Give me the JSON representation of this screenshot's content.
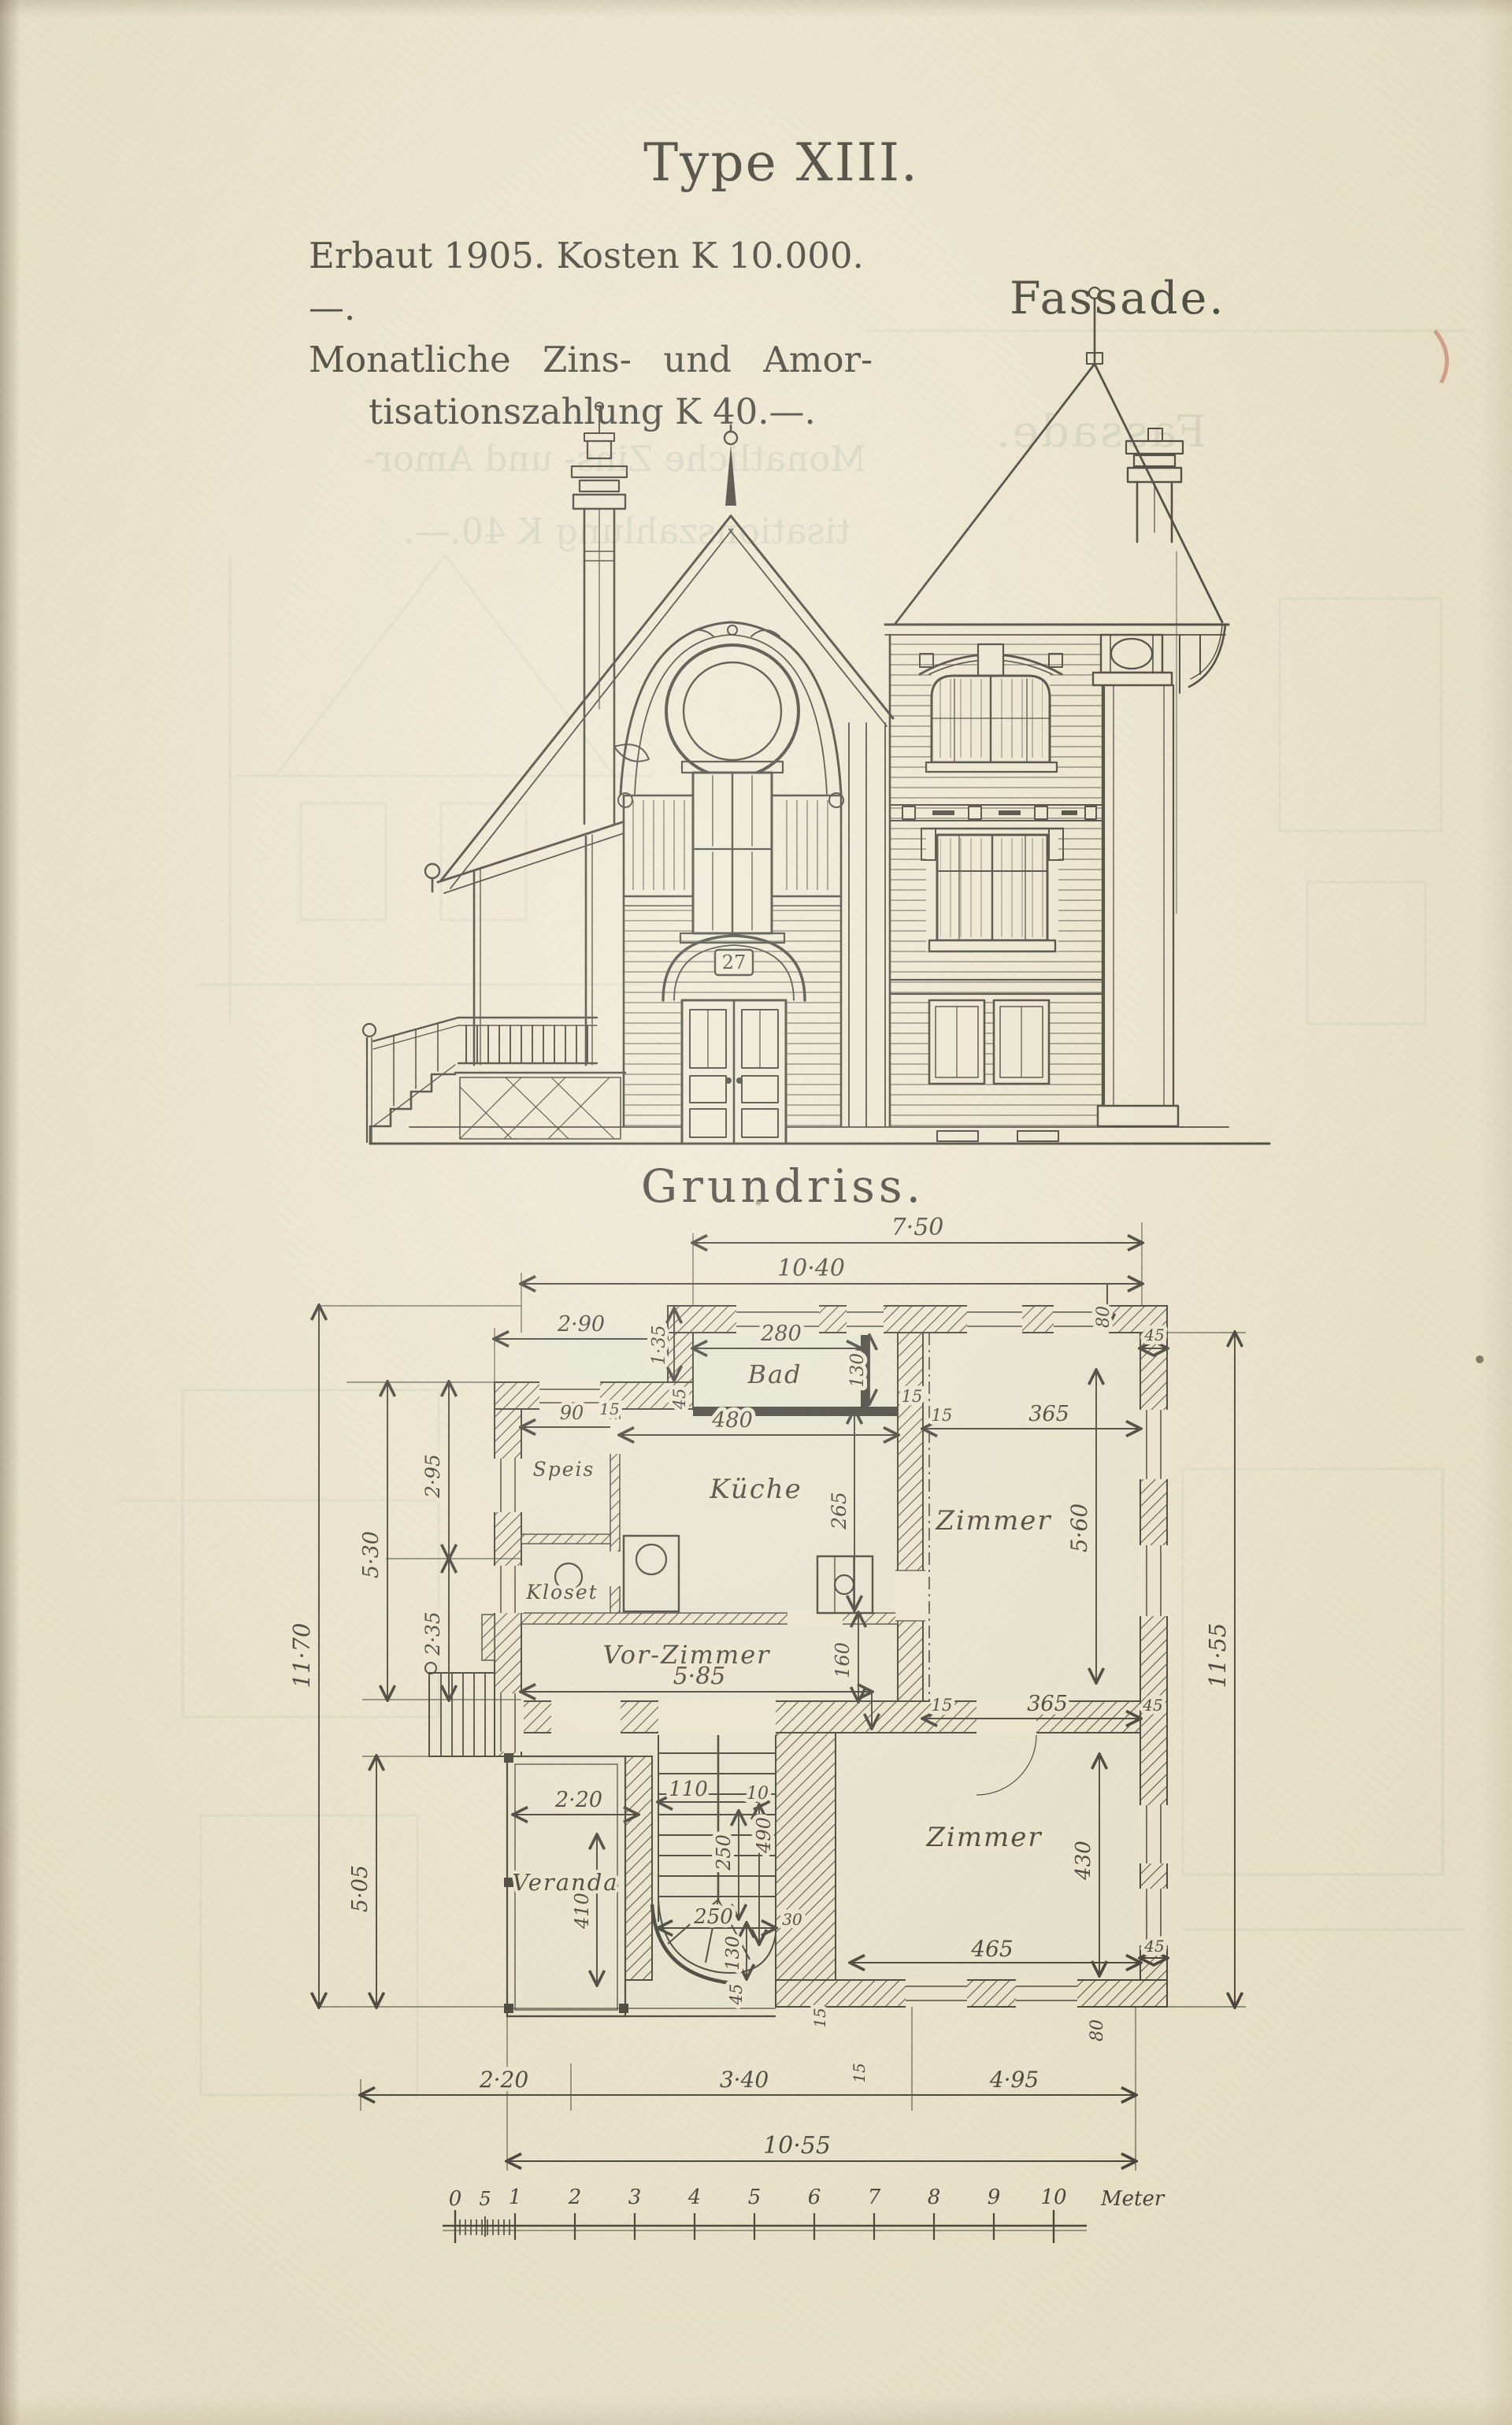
{
  "page": {
    "title": "Type XIII."
  },
  "info": {
    "line1": "Erbaut 1905. Kosten K 10.000.—.",
    "line2": "Monatliche Zins- und Amor-",
    "line3": "tisationszahlung K 40.—."
  },
  "facade": {
    "label": "Fassade.",
    "door_number": "27"
  },
  "plan": {
    "label": "Grundriss.",
    "rooms": {
      "bad": "Bad",
      "kueche": "Küche",
      "zimmer_top": "Zimmer",
      "vorzimmer": "Vor-Zimmer",
      "zimmer_bottom": "Zimmer",
      "veranda": "Veranda",
      "speis": "Speis",
      "kloset": "Kloset"
    },
    "dims": {
      "top_width": "7·50",
      "top_width2": "10·40",
      "wing_width": "2·90",
      "wing_offset": "1·35",
      "bad_width": "280",
      "bad_depth": "130",
      "zimmer_top_width": "365",
      "zimmer_top_width2": "365",
      "zimmer_top_depth": "5·60",
      "speis_door": "90",
      "kueche_width": "480",
      "kueche_depth": "265",
      "vorzimmer_width": "5·85",
      "vorzimmer_depth": "160",
      "right_height": "11·55",
      "left_height": "11·70",
      "left_upper": "5·30",
      "left_295": "2·95",
      "left_235": "2·35",
      "left_lower": "5·05",
      "veranda_width": "2·20",
      "veranda_depth": "410",
      "stair_width": "110",
      "stair_10": "10",
      "stair_250v": "250",
      "stair_490": "490",
      "stair_250h": "250",
      "stair_130": "130",
      "bad_130": "130",
      "zimmer_bottom_width": "465",
      "zimmer_bottom_depth": "430",
      "w30": "30",
      "w80_a": "80",
      "w80_b": "80",
      "w45_a": "45",
      "w45_b": "45",
      "w45_c": "45",
      "w45_d": "45",
      "w45_e": "45",
      "w15_a": "15",
      "w15_b": "15",
      "w15_c": "15",
      "w15_d": "15",
      "w15_e": "15",
      "w15_f": "15",
      "bottom_220": "2·20",
      "bottom_340": "3·40",
      "bottom_495": "4·95",
      "total_width": "10·55"
    },
    "scale": {
      "ticks": [
        "0",
        "5",
        "1",
        "2",
        "3",
        "4",
        "5",
        "6",
        "7",
        "8",
        "9",
        "10"
      ],
      "unit": "Meter"
    }
  },
  "colors": {
    "paper": "#ece6d0",
    "ink": "#2d2b25",
    "ghost": "#8fa89b",
    "red_mark": "#b5483c"
  }
}
